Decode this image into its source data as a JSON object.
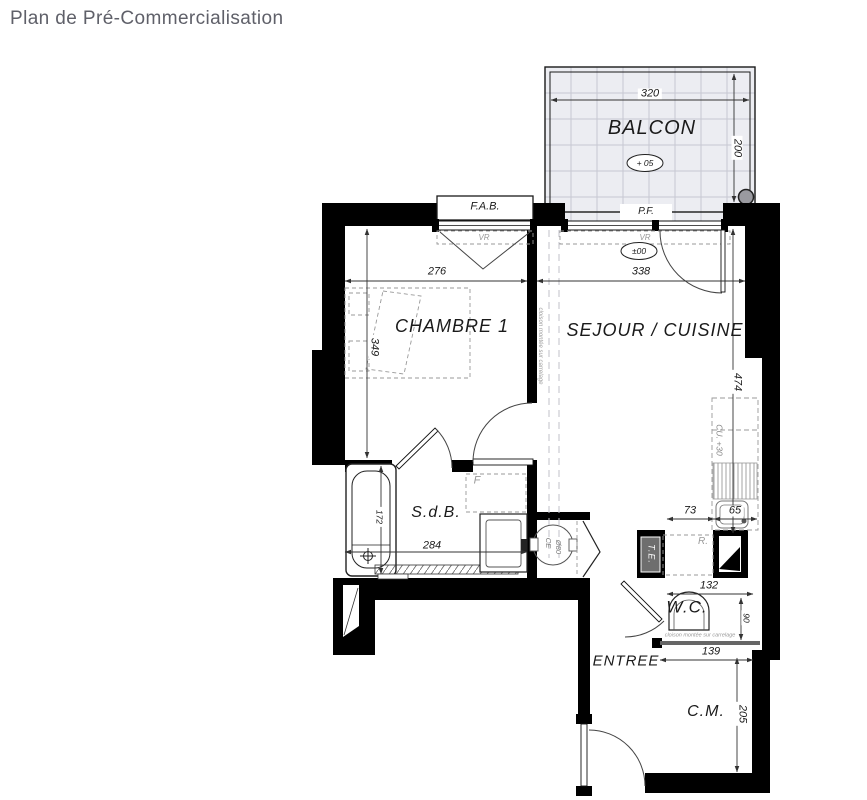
{
  "page": {
    "title": "Plan de Pré-Commercialisation"
  },
  "colors": {
    "wall": "#000000",
    "line": "#1a1a1a",
    "dim": "#333333",
    "muted": "#8d8d95",
    "balcony_fill": "#ecedf2",
    "balcony_grid": "#c6c8d2",
    "title": "#5f6069"
  },
  "rooms": {
    "balcon": {
      "label": "BALCON",
      "level": "+ 05"
    },
    "chambre": {
      "label": "CHAMBRE 1"
    },
    "sejour": {
      "label": "SEJOUR / CUISINE",
      "level": "±00"
    },
    "sdb": {
      "label": "S.d.B."
    },
    "wc": {
      "label": "W.C."
    },
    "entree": {
      "label": "ENTREE"
    },
    "cm": {
      "label": "C.M."
    }
  },
  "dims": {
    "balcon_w": "320",
    "balcon_h": "200",
    "chambre_w": "276",
    "chambre_h": "349",
    "sejour_w": "338",
    "sejour_h": "474",
    "kitchen_left": "73",
    "kitchen_right": "65",
    "sdb_w": "284",
    "bath_len": "172",
    "wc_w": "132",
    "wc_h": "90",
    "entree_w": "139",
    "cm_h": "205"
  },
  "openings": {
    "fab": "F.A.B.",
    "pf": "P.F.",
    "vr_left": "VR",
    "vr_right": "VR"
  },
  "equipment": {
    "panel": "T.E.",
    "fridge": "R.",
    "closet": "F",
    "heater": "CE",
    "heater_diam": "Ø80",
    "kitchen_unit": "CU. +30"
  },
  "notes": {
    "partition_v": "cloison montée sur carrelage",
    "partition_h": "cloison montée sur carrelage"
  }
}
